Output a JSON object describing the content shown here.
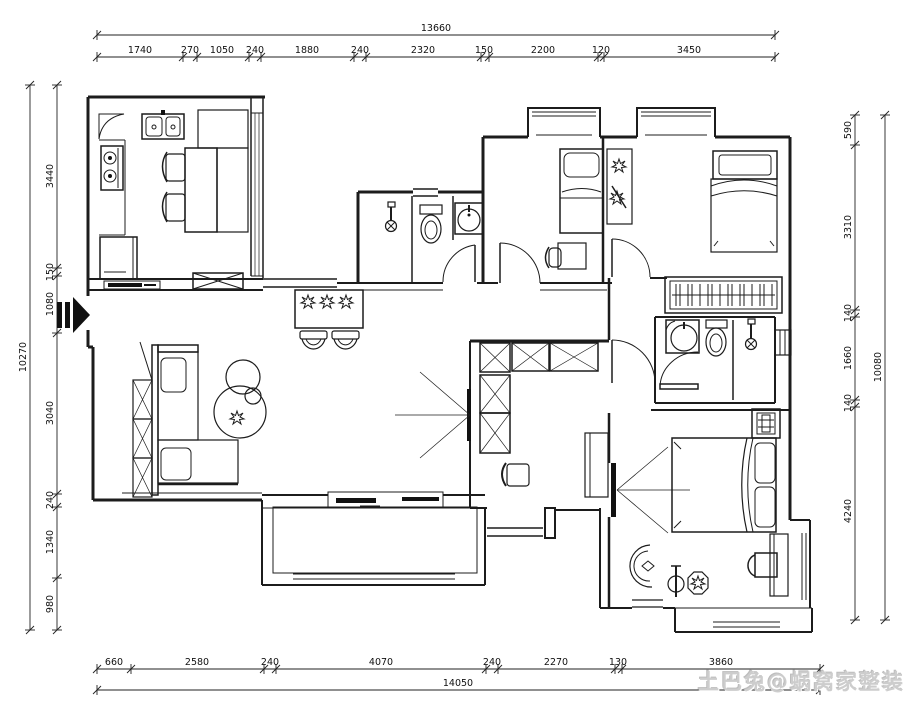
{
  "watermark": "土巴兔@蜗窝家整装",
  "colors": {
    "line": "#1c1c1c",
    "watermark": "#cdcdcd",
    "background": "#ffffff"
  },
  "dimensions": {
    "top": {
      "total": "13660",
      "segments": [
        "1740",
        "270",
        "1050",
        "240",
        "1880",
        "240",
        "2320",
        "150",
        "2200",
        "120",
        "3450"
      ]
    },
    "bottom": {
      "total": "14050",
      "segments": [
        "660",
        "2580",
        "240",
        "4070",
        "240",
        "2270",
        "130",
        "3860"
      ]
    },
    "left": {
      "total": "10270",
      "segments": [
        "3440",
        "150",
        "1080",
        "3040",
        "240",
        "1340",
        "980"
      ]
    },
    "right": {
      "total": "10080",
      "segments": [
        "590",
        "3310",
        "140",
        "1660",
        "140",
        "4240"
      ]
    }
  }
}
